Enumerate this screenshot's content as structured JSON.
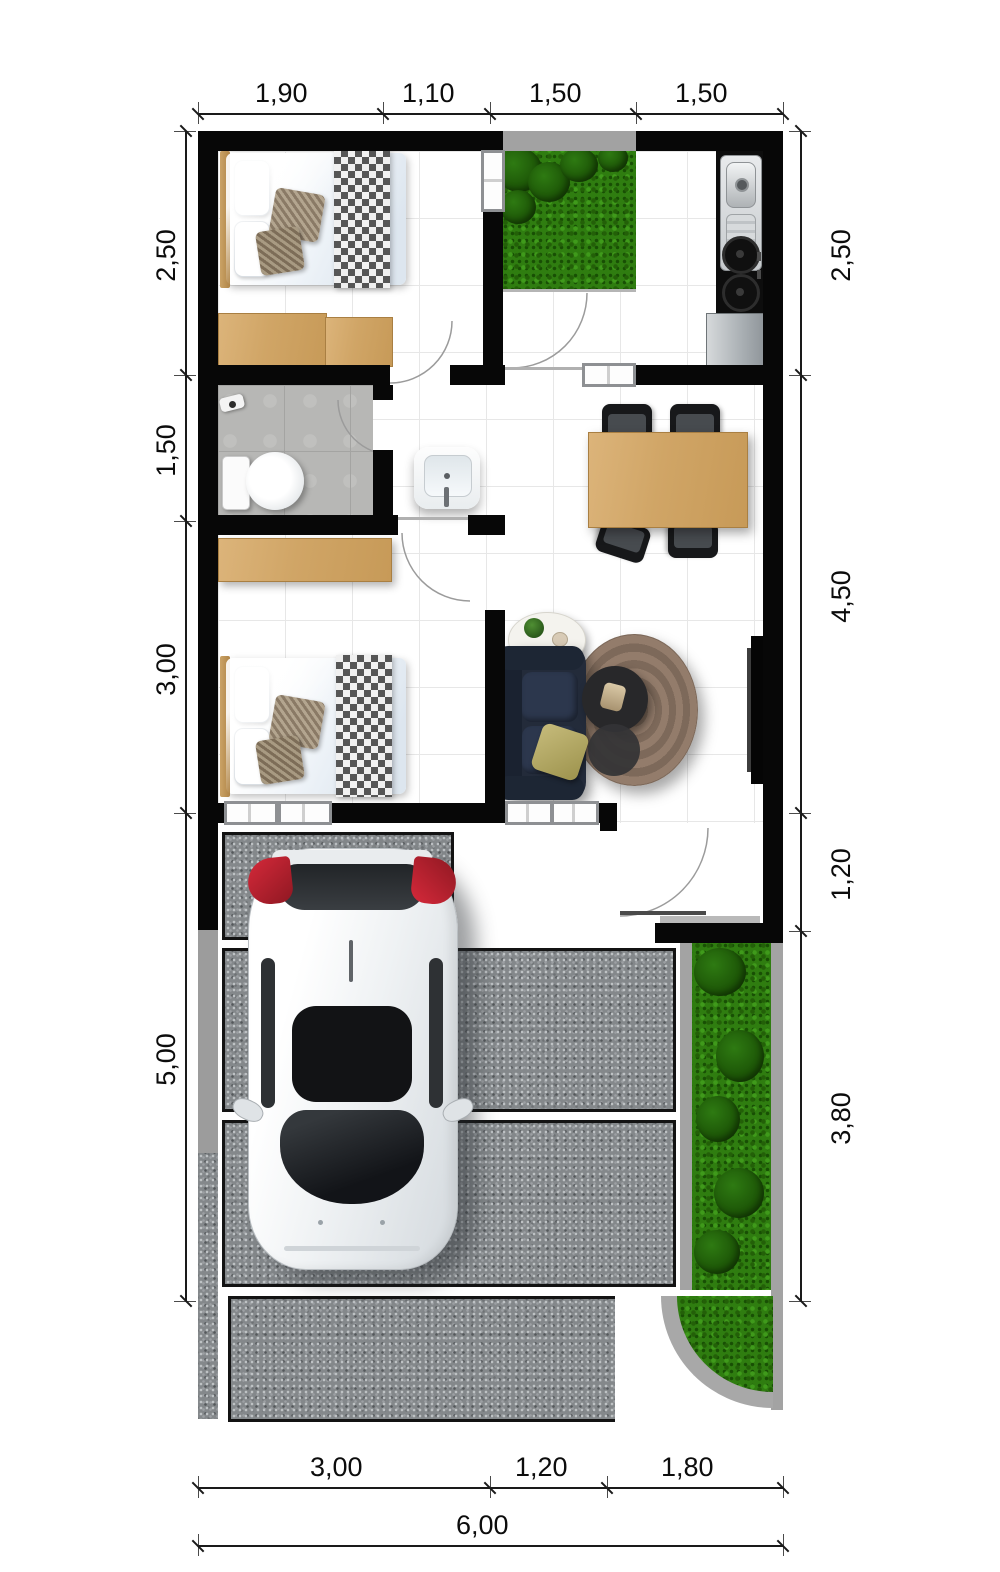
{
  "dimensions": {
    "top": [
      "1,90",
      "1,10",
      "1,50",
      "1,50"
    ],
    "left": [
      "2,50",
      "1,50",
      "3,00",
      "5,00"
    ],
    "right": [
      "2,50",
      "4,50",
      "1,20",
      "3,80"
    ],
    "bottom": [
      "3,00",
      "1,20",
      "1,80"
    ],
    "total": "6,00"
  },
  "colors": {
    "wall": "#070707",
    "grass": "#2f7d10",
    "gravel": "#84888b",
    "wood": "#d4aa6e",
    "bath_floor": "#b7b7b5",
    "sofa": "#273041",
    "rug": "#8d7767",
    "car_taillight": "#b51f2b",
    "garden_border": "#a3a3a3"
  }
}
